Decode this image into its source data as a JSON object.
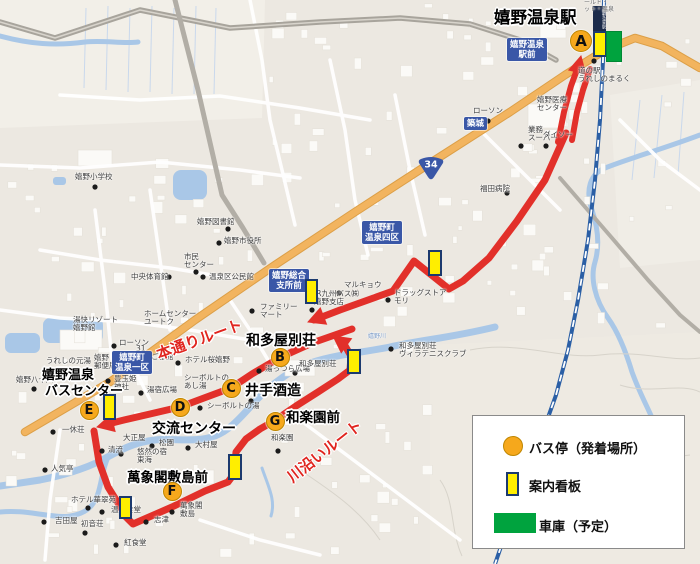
{
  "title": {
    "text": "嬉野温泉駅"
  },
  "station_tag": {
    "text": "嬉野温泉駅"
  },
  "route_shield": {
    "number": "34"
  },
  "legend": {
    "items": [
      {
        "swatch": "bus-stop-circle",
        "label": "バス停（発着場所）"
      },
      {
        "swatch": "signboard-rect",
        "label": "案内看板"
      },
      {
        "swatch": "garage-rect",
        "label": "車庫（予定）"
      }
    ]
  },
  "colors": {
    "route": "#e2302a",
    "stop_fill": "#f6a81c",
    "sign_fill": "#ffee00",
    "sign_border": "#1c3a6e",
    "garage": "#00a33e",
    "label_blue": "#3a57a7",
    "rail": "#2b5fa5",
    "river": "#a9c7e7",
    "road_orange": "#f2b45f",
    "dot": "#1b1b1b"
  },
  "stops": [
    {
      "letter": "A",
      "x": 581,
      "y": 41,
      "r": 11
    },
    {
      "letter": "B",
      "x": 280,
      "y": 357,
      "r": 9.5
    },
    {
      "letter": "C",
      "x": 231,
      "y": 388,
      "r": 9.5
    },
    {
      "letter": "D",
      "x": 180,
      "y": 407,
      "r": 9.5
    },
    {
      "letter": "E",
      "x": 89,
      "y": 410,
      "r": 9.5
    },
    {
      "letter": "F",
      "x": 172,
      "y": 491,
      "r": 9.5
    },
    {
      "letter": "G",
      "x": 275,
      "y": 421,
      "r": 9.5
    }
  ],
  "stop_labels": [
    {
      "text": "和多屋別荘",
      "x": 246,
      "y": 330,
      "size": 14
    },
    {
      "text": "井手酒造",
      "x": 245,
      "y": 380,
      "size": 14
    },
    {
      "text": "交流センター",
      "x": 152,
      "y": 418,
      "size": 14
    },
    {
      "text": "嬉野温泉",
      "x": 42,
      "y": 364,
      "size": 13
    },
    {
      "text": "バスセンター",
      "x": 45,
      "y": 380,
      "size": 13
    },
    {
      "text": "萬象閣敷島前",
      "x": 127,
      "y": 466,
      "size": 13.5
    },
    {
      "text": "和楽園前",
      "x": 286,
      "y": 406,
      "size": 13.5
    }
  ],
  "route_labels": [
    {
      "text": "本通りルート",
      "x": 157,
      "y": 344,
      "rot": -20,
      "size": 15
    },
    {
      "text": "川沿いルート",
      "x": 289,
      "y": 468,
      "rot": -38,
      "size": 15
    }
  ],
  "routes": [
    {
      "name": "main-street-route",
      "w": 7,
      "pts": "566,133 545,180 517,221 489,258 463,281 449,289 414,261 393,291 368,300 340,310 314,320"
    },
    {
      "name": "station-loop-left",
      "w": 6,
      "pts": "558,142 564,112 571,86 579,64"
    },
    {
      "name": "station-loop-right",
      "w": 6,
      "pts": "572,140 577,112 583,90 590,69"
    },
    {
      "name": "shared-town-segment",
      "w": 7,
      "pts": "352,329 312,343 281,357 252,374 231,388 204,398 180,407 150,414 124,420 104,425"
    },
    {
      "name": "riverside-route",
      "w": 7,
      "pts": "94,431 99,462 108,487 118,503 126,517 133,524 172,507 205,491 228,482 234,474 236,452 246,439 260,429 274,421 296,406 318,392 338,379 350,370 351,356 344,344"
    }
  ],
  "route_arrows": [
    {
      "x": 581,
      "y": 56,
      "a": 283
    },
    {
      "x": 308,
      "y": 322,
      "a": 159
    },
    {
      "x": 97,
      "y": 427,
      "a": 166
    },
    {
      "x": 333,
      "y": 336,
      "a": 216
    }
  ],
  "signboards": [
    {
      "x": 593,
      "y": 31,
      "w": 14,
      "h": 26
    },
    {
      "x": 428,
      "y": 250,
      "w": 14,
      "h": 26
    },
    {
      "x": 305,
      "y": 279,
      "w": 13,
      "h": 25
    },
    {
      "x": 347,
      "y": 349,
      "w": 14,
      "h": 25
    },
    {
      "x": 103,
      "y": 394,
      "w": 13,
      "h": 26
    },
    {
      "x": 228,
      "y": 454,
      "w": 14,
      "h": 26
    },
    {
      "x": 119,
      "y": 496,
      "w": 13,
      "h": 23
    }
  ],
  "garage": {
    "x": 606,
    "y": 31,
    "w": 16,
    "h": 31
  },
  "blue_labels": [
    {
      "lines": [
        "嬉野温泉",
        "駅前"
      ],
      "x": 507,
      "y": 38
    },
    {
      "lines": [
        "築城"
      ],
      "x": 464,
      "y": 117
    },
    {
      "lines": [
        "嬉野町",
        "温泉四区"
      ],
      "x": 362,
      "y": 221
    },
    {
      "lines": [
        "嬉野総合",
        "支所前"
      ],
      "x": 269,
      "y": 269
    },
    {
      "lines": [
        "嬉野町",
        "温泉一区"
      ],
      "x": 112,
      "y": 351
    }
  ],
  "pois": [
    {
      "l": [
        "ールド・",
        "ット・温泉"
      ],
      "x": 584,
      "y": 0,
      "s": 6,
      "c": "#666"
    },
    {
      "l": [
        "道の駅",
        "うれしのまるく"
      ],
      "x": 578,
      "y": 67,
      "d": [
        594,
        61
      ]
    },
    {
      "l": [
        "嬉野医療",
        "センター"
      ],
      "x": 537,
      "y": 96
    },
    {
      "l": [
        "ローソン"
      ],
      "x": 473,
      "y": 107,
      "d": [
        488,
        121
      ]
    },
    {
      "l": [
        "業務",
        "スーパー"
      ],
      "x": 528,
      "y": 126,
      "d": [
        521,
        146
      ]
    },
    {
      "l": [
        "ダイソー"
      ],
      "x": 543,
      "y": 131,
      "d": [
        546,
        146
      ]
    },
    {
      "l": [
        "福田病院"
      ],
      "x": 480,
      "y": 185,
      "d": [
        507,
        193
      ]
    },
    {
      "l": [
        "嬉野小学校"
      ],
      "x": 75,
      "y": 173,
      "d": [
        95,
        187
      ]
    },
    {
      "l": [
        "嬉野図書館"
      ],
      "x": 197,
      "y": 218,
      "d": [
        228,
        229
      ]
    },
    {
      "l": [
        "嬉野市役所"
      ],
      "x": 224,
      "y": 237,
      "d": [
        219,
        243
      ]
    },
    {
      "l": [
        "市民",
        "センター"
      ],
      "x": 184,
      "y": 253,
      "d": [
        196,
        272
      ]
    },
    {
      "l": [
        "中央体育館"
      ],
      "x": 131,
      "y": 273,
      "d": [
        169,
        277
      ]
    },
    {
      "l": [
        "温泉区公民館"
      ],
      "x": 209,
      "y": 273,
      "d": [
        203,
        277
      ]
    },
    {
      "l": [
        "ホームセンター",
        "ユートク"
      ],
      "x": 144,
      "y": 310
    },
    {
      "l": [
        "マルキョウ"
      ],
      "x": 344,
      "y": 281,
      "d": [
        339,
        293
      ]
    },
    {
      "l": [
        "ドラッグストア",
        "モリ"
      ],
      "x": 394,
      "y": 289,
      "d": [
        388,
        300
      ]
    },
    {
      "l": [
        "ファミリー",
        "マート"
      ],
      "x": 260,
      "y": 303,
      "d": [
        252,
        311
      ]
    },
    {
      "l": [
        "JR九州バス㈱",
        "嬉野支店"
      ],
      "x": 314,
      "y": 290,
      "d": [
        312,
        310
      ]
    },
    {
      "l": [
        "湯快リゾート",
        "嬉野館"
      ],
      "x": 73,
      "y": 316
    },
    {
      "l": [
        "うれしの元湯"
      ],
      "x": 46,
      "y": 357
    },
    {
      "l": [
        "嬉野",
        "郵便局"
      ],
      "x": 94,
      "y": 354
    },
    {
      "l": [
        "豊玉姫",
        "神社"
      ],
      "x": 114,
      "y": 375,
      "d": [
        108,
        381
      ]
    },
    {
      "l": [
        "嬉野八十八"
      ],
      "x": 16,
      "y": 376,
      "d": [
        34,
        389
      ]
    },
    {
      "l": [
        "ローソン"
      ],
      "x": 119,
      "y": 339,
      "d": [
        114,
        346
      ]
    },
    {
      "l": [
        "31",
        "ひさご旅館"
      ],
      "x": 136,
      "y": 345
    },
    {
      "l": [
        "ホテル桜嬉野"
      ],
      "x": 185,
      "y": 356,
      "d": [
        178,
        363
      ]
    },
    {
      "l": [
        "シーボルトの",
        "あし湯"
      ],
      "x": 184,
      "y": 374
    },
    {
      "l": [
        "湯宿広場"
      ],
      "x": 147,
      "y": 386,
      "d": [
        141,
        393
      ]
    },
    {
      "l": [
        "シーボルトの湯"
      ],
      "x": 207,
      "y": 402,
      "d": [
        200,
        408
      ]
    },
    {
      "l": [
        "湯っつら広場"
      ],
      "x": 265,
      "y": 365,
      "d": [
        259,
        371
      ]
    },
    {
      "l": [
        "和多屋別荘"
      ],
      "x": 299,
      "y": 360,
      "d": [
        295,
        373
      ]
    },
    {
      "l": [
        "和多屋別荘",
        "ヴィラテニスクラブ"
      ],
      "x": 399,
      "y": 342,
      "d": [
        391,
        349
      ]
    },
    {
      "l": [
        "嬉野川"
      ],
      "x": 368,
      "y": 334,
      "s": 6,
      "c": "#7b9cc9"
    },
    {
      "l": [
        "大正屋"
      ],
      "x": 123,
      "y": 434,
      "d": [
        121,
        454
      ]
    },
    {
      "l": [
        "松園"
      ],
      "x": 159,
      "y": 439,
      "d": [
        152,
        446
      ]
    },
    {
      "l": [
        "大村屋"
      ],
      "x": 195,
      "y": 441,
      "d": [
        188,
        448
      ]
    },
    {
      "l": [
        "悠然の宿",
        "東海"
      ],
      "x": 137,
      "y": 448
    },
    {
      "l": [
        "清流"
      ],
      "x": 108,
      "y": 446,
      "d": [
        102,
        451
      ]
    },
    {
      "l": [
        "一休荘"
      ],
      "x": 62,
      "y": 426,
      "d": [
        53,
        432
      ]
    },
    {
      "l": [
        "人気亭"
      ],
      "x": 51,
      "y": 465,
      "d": [
        45,
        470
      ]
    },
    {
      "l": [
        "ホテル華翠苑"
      ],
      "x": 71,
      "y": 496,
      "d": [
        88,
        508
      ]
    },
    {
      "l": [
        "温泉食堂"
      ],
      "x": 111,
      "y": 506,
      "d": [
        102,
        512
      ]
    },
    {
      "l": [
        "萬象閣",
        "敷島"
      ],
      "x": 180,
      "y": 502,
      "d": [
        172,
        512
      ]
    },
    {
      "l": [
        "志津"
      ],
      "x": 154,
      "y": 516,
      "d": [
        146,
        522
      ]
    },
    {
      "l": [
        "紅食堂"
      ],
      "x": 124,
      "y": 539,
      "d": [
        116,
        545
      ]
    },
    {
      "l": [
        "吉田屋"
      ],
      "x": 55,
      "y": 517,
      "d": [
        44,
        522
      ]
    },
    {
      "l": [
        "初音荘"
      ],
      "x": 81,
      "y": 520,
      "d": [
        85,
        533
      ]
    },
    {
      "l": [
        "和楽園"
      ],
      "x": 271,
      "y": 434,
      "d": [
        278,
        451
      ]
    }
  ],
  "extra_dots": [
    [
      251,
      401
    ]
  ]
}
